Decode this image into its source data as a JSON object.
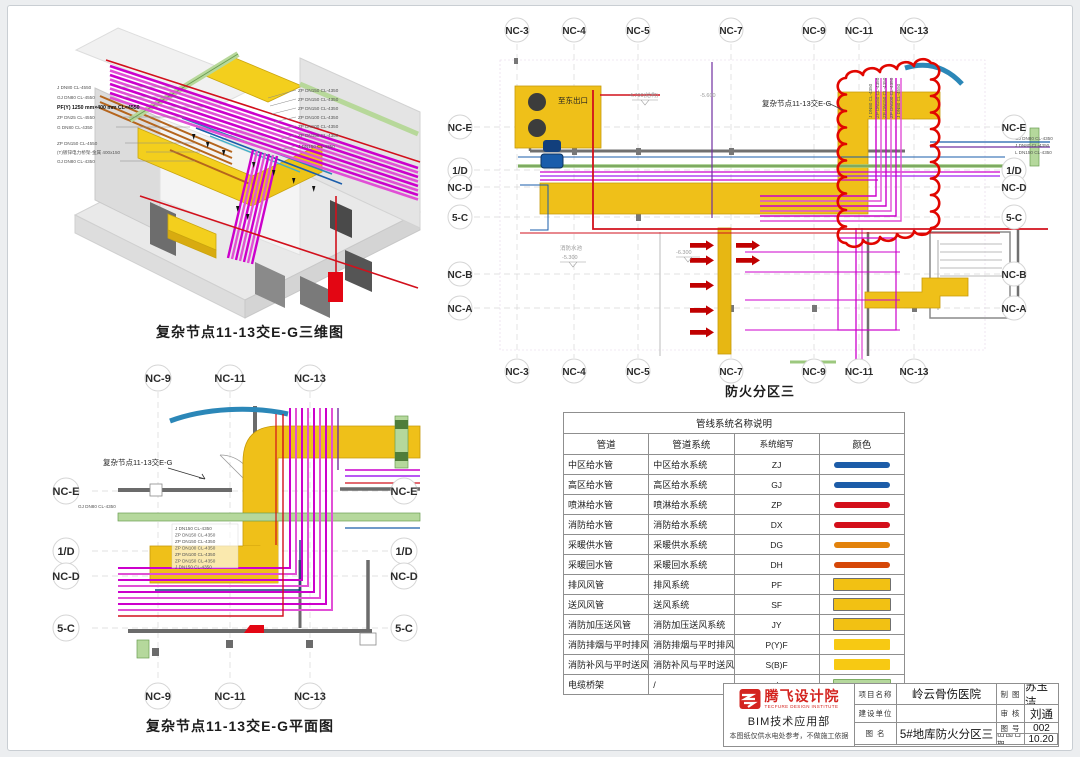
{
  "views": {
    "iso": {
      "caption": "复杂节点11-13交E-G三维图",
      "labels_left": [
        "J DN80 CL-4550",
        "GJ DN80 CL-4550",
        "PF(Y) 1250 mm×400 mm CL=4550",
        "ZP DN25 CL-4550",
        "G DN80 CL-4350",
        "ZP DN150 CL-4550",
        "(T)镀锌电力桥架-金属 400x150",
        "GJ DN80 CL-4350"
      ],
      "labels_right": [
        "ZP DN150 CL-4350",
        "ZP DN150 CL-4350",
        "ZP DN150 CL-4350",
        "ZP DN100 CL-4350",
        "ZP DN100 CL-4350",
        "ZP DN150 CL-4350",
        "J DN150 CL-4350"
      ]
    },
    "plan_main": {
      "caption": "防火分区三",
      "grid_cols": [
        "NC-3",
        "NC-4",
        "NC-5",
        "NC-7",
        "NC-9",
        "NC-11",
        "NC-13"
      ],
      "grid_rows": [
        "NC-E",
        "1/D",
        "NC-D",
        "5-C",
        "NC-B",
        "NC-A"
      ],
      "node_label": "复杂节点11-13交E-G",
      "exit_label": "至东出口",
      "pool_label": "消防水池",
      "pool_elev": "-5.300",
      "elev_a": "-4.700(结构)",
      "elev_b": "-5.600",
      "elev_c": "-6.300",
      "edge_tags": [
        "GJ DN80 CL-4350",
        "J DN80 CL-4350",
        "L DN150 CL-4350"
      ],
      "riser_tags": [
        "J DN80 CL-4350",
        "ZP DN150 CL-4350",
        "ZP DN150 CL-4350",
        "ZP DN100 CL-4350",
        "J DN80 CL-4550"
      ]
    },
    "plan_node": {
      "caption": "复杂节点11-13交E-G平面图",
      "grid_cols": [
        "NC-9",
        "NC-11",
        "NC-13"
      ],
      "grid_rows": [
        "NC-E",
        "1/D",
        "NC-D",
        "5-C"
      ],
      "node_label": "复杂节点11-13交E-G",
      "stack_tags": [
        "J DN150 CL-4350",
        "ZP DN150 CL-4350",
        "ZP DN150 CL-4350",
        "ZP DN100 CL-4350",
        "ZP DN100 CL-4350",
        "ZP DN150 CL-4350",
        "J DN150 CL-4350"
      ],
      "left_tag": "GJ DN80 CL-4350"
    }
  },
  "legend": {
    "title": "管线系统名称说明",
    "headers": [
      "管道",
      "管道系统",
      "系统缩写",
      "颜色"
    ],
    "rows": [
      {
        "pipe": "中区给水管",
        "system": "中区给水系统",
        "abbr": "ZJ",
        "style": "line",
        "color": "#1c5ca8"
      },
      {
        "pipe": "高区给水管",
        "system": "高区给水系统",
        "abbr": "GJ",
        "style": "line",
        "color": "#1c5ca8"
      },
      {
        "pipe": "喷淋给水管",
        "system": "喷淋给水系统",
        "abbr": "ZP",
        "style": "line",
        "color": "#d30f1a"
      },
      {
        "pipe": "消防给水管",
        "system": "消防给水系统",
        "abbr": "DX",
        "style": "line",
        "color": "#d30f1a"
      },
      {
        "pipe": "采暖供水管",
        "system": "采暖供水系统",
        "abbr": "DG",
        "style": "line",
        "color": "#e2820c"
      },
      {
        "pipe": "采暖回水管",
        "system": "采暖回水系统",
        "abbr": "DH",
        "style": "line",
        "color": "#d54708"
      },
      {
        "pipe": "排风风管",
        "system": "排风系统",
        "abbr": "PF",
        "style": "duct",
        "color": "#f2c113"
      },
      {
        "pipe": "送风风管",
        "system": "送风系统",
        "abbr": "SF",
        "style": "duct",
        "color": "#f2c113"
      },
      {
        "pipe": "消防加压送风管",
        "system": "消防加压送风系统",
        "abbr": "JY",
        "style": "duct",
        "color": "#f2c113"
      },
      {
        "pipe": "消防排烟与平时排风合用风管",
        "system": "消防排烟与平时排风合用系统",
        "abbr": "P(Y)F",
        "style": "duct-plain",
        "color": "#f7c913"
      },
      {
        "pipe": "消防补风与平时送风合用风管",
        "system": "消防补风与平时送风合用系统",
        "abbr": "S(B)F",
        "style": "duct-plain",
        "color": "#f7c913"
      },
      {
        "pipe": "电缆桥架",
        "system": "/",
        "abbr": "/",
        "style": "tray",
        "color": "#b5d89c"
      }
    ]
  },
  "titleblock": {
    "logo_cn": "腾飞设计院",
    "logo_en": "TECFURE DESIGN INSTITUTE",
    "dept": "BIM技术应用部",
    "disclaimer": "本图纸仅供水电处参考，不做施工依据",
    "project_label": "项目名称",
    "project_value": "岭云骨伤医院",
    "client_label": "建设单位",
    "client_value": "",
    "drawing_label": "图  名",
    "drawing_value": "5#地库防火分区三",
    "drafter_label": "制 图",
    "drafter_value": "苏玉洁",
    "checker_label": "审 核",
    "checker_value": "刘通",
    "number_label": "图 号",
    "number_value": "002",
    "date_label": "出图日期",
    "date_value": "10.20"
  }
}
